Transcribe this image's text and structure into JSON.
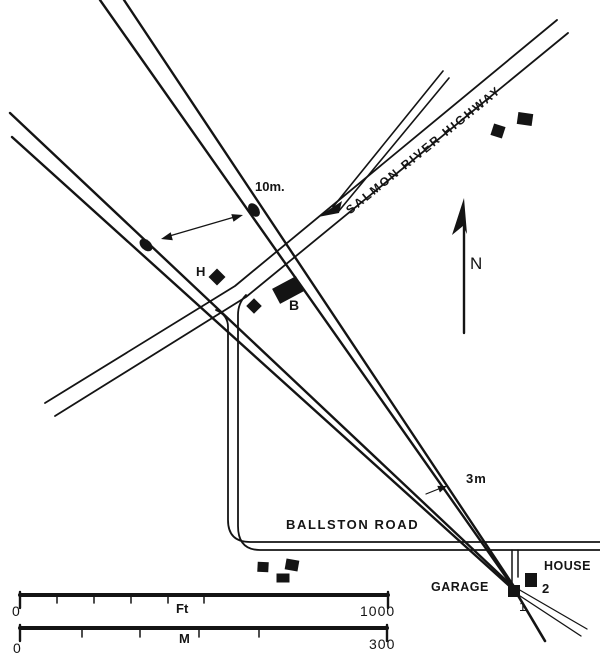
{
  "map": {
    "road_labels": {
      "highway": "SALMON RIVER HIGHWAY",
      "ballston": "BALLSTON ROAD"
    },
    "feature_labels": {
      "house": "HOUSE",
      "garage": "GARAGE",
      "building_b": "B",
      "building_h": "H",
      "point_1": "1",
      "point_2": "2"
    },
    "measurements": {
      "offset_10m": "10m.",
      "offset_3m": "3m"
    },
    "north_label": "N",
    "scale_feet": {
      "start": "0",
      "unit": "Ft",
      "end": "1000"
    },
    "scale_meters": {
      "start": "0",
      "unit": "M",
      "end": "300"
    },
    "colors": {
      "ink": "#141414",
      "background": "#ffffff"
    }
  }
}
